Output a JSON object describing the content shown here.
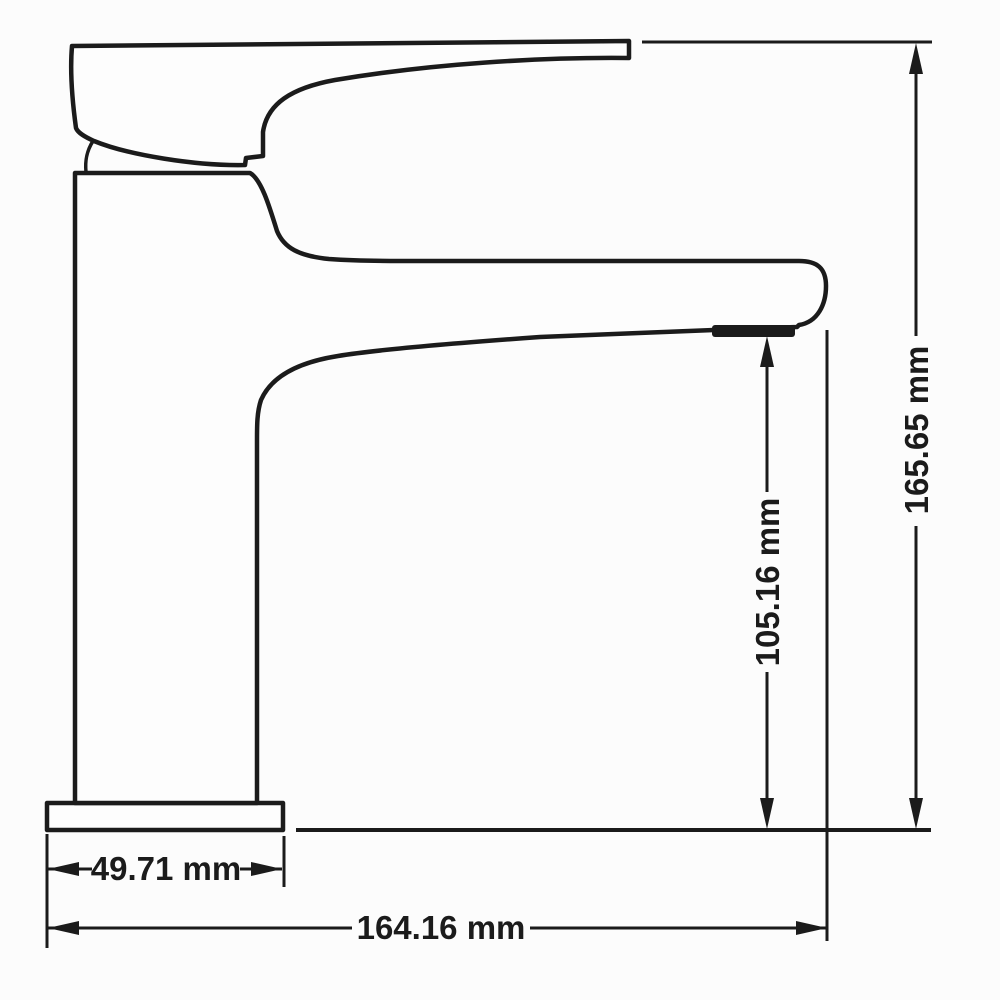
{
  "page": {
    "background": "#fcfcfc",
    "line_color": "#1b1b1b"
  },
  "drawing": {
    "type": "technical_dimension_drawing",
    "subject": "single-lever basin faucet, side elevation",
    "units": "mm",
    "dimensions": {
      "overall_height": {
        "label": "165.65 mm",
        "value": 165.65
      },
      "spout_outlet_height": {
        "label": "105.16 mm",
        "value": 105.16
      },
      "base_width": {
        "label": "49.71 mm",
        "value": 49.71
      },
      "overall_length": {
        "label": "164.16 mm",
        "value": 164.16
      }
    }
  }
}
